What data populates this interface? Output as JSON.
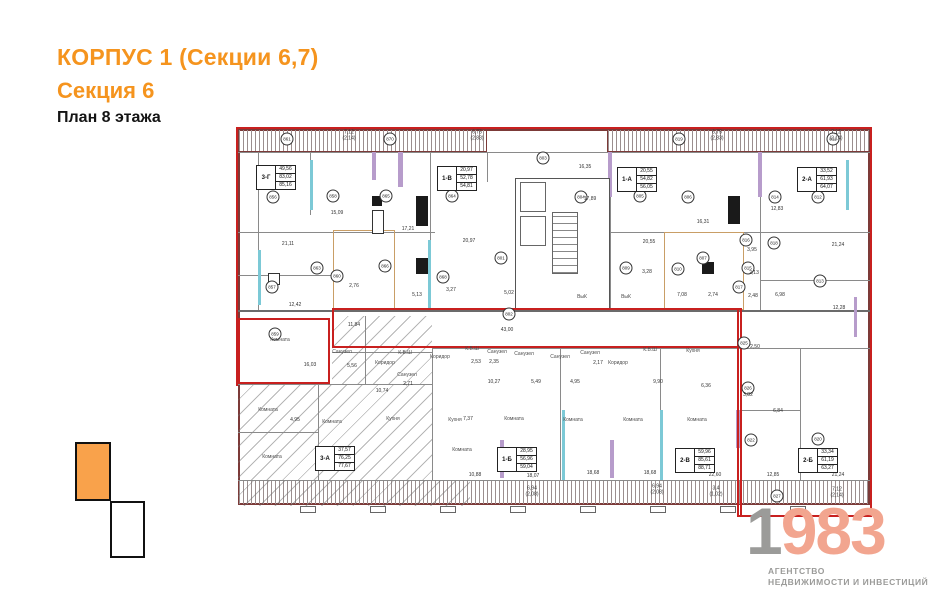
{
  "header": {
    "title": "КОРПУС 1 (Секции 6,7)",
    "subtitle": "Секция 6",
    "floor": "План 8 этажа"
  },
  "colors": {
    "accent_orange": "#F5941E",
    "wall_maroon": "#7C3A38",
    "highlight_red": "#C8201F",
    "teal_wall": "#7CC9D6",
    "purple_wall": "#B79CCB",
    "tan_wall": "#C99E66",
    "logo_gray": "#9B9B99",
    "logo_salmon": "#F2A58F"
  },
  "logo": {
    "year_first": "1",
    "year_rest": "983",
    "tagline1": "АГЕНТСТВО",
    "tagline2": "НЕДВИЖИМОСТИ И ИНВЕСТИЦИЙ"
  },
  "plan": {
    "apartments": [
      {
        "unit": "3-Г",
        "areas": [
          "49,56",
          "83,02",
          "85,16"
        ],
        "x": 23,
        "y": 40
      },
      {
        "unit": "1-В",
        "areas": [
          "20,97",
          "52,78",
          "54,81"
        ],
        "x": 204,
        "y": 41
      },
      {
        "unit": "1-А",
        "areas": [
          "20,55",
          "54,82",
          "56,05"
        ],
        "x": 384,
        "y": 42
      },
      {
        "unit": "2-А",
        "areas": [
          "33,52",
          "61,93",
          "64,07"
        ],
        "x": 564,
        "y": 42
      },
      {
        "unit": "3-А",
        "areas": [
          "37,57",
          "76,25",
          "77,67"
        ],
        "x": 82,
        "y": 321
      },
      {
        "unit": "1-Б",
        "areas": [
          "28,95",
          "56,96",
          "59,04"
        ],
        "x": 264,
        "y": 322
      },
      {
        "unit": "2-В",
        "areas": [
          "59,96",
          "85,61",
          "88,71"
        ],
        "x": 442,
        "y": 323
      },
      {
        "unit": "2-Б",
        "areas": [
          "33,34",
          "61,19",
          "63,27"
        ],
        "x": 565,
        "y": 323
      }
    ],
    "circles": [
      {
        "n": "861",
        "x": 54,
        "y": 14
      },
      {
        "n": "870",
        "x": 157,
        "y": 14
      },
      {
        "n": "819",
        "x": 446,
        "y": 14
      },
      {
        "n": "811",
        "x": 600,
        "y": 14
      },
      {
        "n": "856",
        "x": 40,
        "y": 72
      },
      {
        "n": "858",
        "x": 100,
        "y": 71
      },
      {
        "n": "865",
        "x": 153,
        "y": 71
      },
      {
        "n": "864",
        "x": 219,
        "y": 71
      },
      {
        "n": "803",
        "x": 310,
        "y": 33
      },
      {
        "n": "804",
        "x": 348,
        "y": 72
      },
      {
        "n": "805",
        "x": 407,
        "y": 71
      },
      {
        "n": "806",
        "x": 455,
        "y": 72
      },
      {
        "n": "814",
        "x": 542,
        "y": 72
      },
      {
        "n": "812",
        "x": 585,
        "y": 72
      },
      {
        "n": "857",
        "x": 39,
        "y": 162
      },
      {
        "n": "863",
        "x": 84,
        "y": 143
      },
      {
        "n": "860",
        "x": 104,
        "y": 151
      },
      {
        "n": "866",
        "x": 152,
        "y": 141
      },
      {
        "n": "868",
        "x": 210,
        "y": 152
      },
      {
        "n": "801",
        "x": 268,
        "y": 133
      },
      {
        "n": "809",
        "x": 393,
        "y": 143
      },
      {
        "n": "807",
        "x": 470,
        "y": 133
      },
      {
        "n": "810",
        "x": 445,
        "y": 144
      },
      {
        "n": "816",
        "x": 513,
        "y": 115
      },
      {
        "n": "818",
        "x": 541,
        "y": 118
      },
      {
        "n": "815",
        "x": 515,
        "y": 143
      },
      {
        "n": "817",
        "x": 506,
        "y": 162
      },
      {
        "n": "813",
        "x": 587,
        "y": 156
      },
      {
        "n": "802",
        "x": 276,
        "y": 189
      },
      {
        "n": "859",
        "x": 42,
        "y": 209
      },
      {
        "n": "825",
        "x": 511,
        "y": 218
      },
      {
        "n": "826",
        "x": 515,
        "y": 263
      },
      {
        "n": "822",
        "x": 518,
        "y": 315
      },
      {
        "n": "820",
        "x": 585,
        "y": 314
      },
      {
        "n": "827",
        "x": 544,
        "y": 371
      }
    ],
    "dims": [
      {
        "t": "21,11",
        "x": 55,
        "y": 120
      },
      {
        "t": "15,09",
        "x": 104,
        "y": 89
      },
      {
        "t": "17,21",
        "x": 175,
        "y": 105
      },
      {
        "t": "20,97",
        "x": 236,
        "y": 117
      },
      {
        "t": "12,42",
        "x": 62,
        "y": 181
      },
      {
        "t": "2,76",
        "x": 121,
        "y": 162
      },
      {
        "t": "5,13",
        "x": 184,
        "y": 171
      },
      {
        "t": "11,84",
        "x": 121,
        "y": 201
      },
      {
        "t": "16,03",
        "x": 77,
        "y": 241
      },
      {
        "t": "5,56",
        "x": 119,
        "y": 242
      },
      {
        "t": "4,95",
        "x": 62,
        "y": 296
      },
      {
        "t": "10,74",
        "x": 149,
        "y": 267
      },
      {
        "t": "16,35",
        "x": 352,
        "y": 43
      },
      {
        "t": "17,89",
        "x": 357,
        "y": 75
      },
      {
        "t": "20,55",
        "x": 416,
        "y": 118
      },
      {
        "t": "16,31",
        "x": 470,
        "y": 98
      },
      {
        "t": "12,83",
        "x": 544,
        "y": 85
      },
      {
        "t": "3,95",
        "x": 519,
        "y": 126
      },
      {
        "t": "2,13",
        "x": 521,
        "y": 149
      },
      {
        "t": "21,24",
        "x": 605,
        "y": 121
      },
      {
        "t": "3,28",
        "x": 414,
        "y": 148
      },
      {
        "t": "7,08",
        "x": 449,
        "y": 171
      },
      {
        "t": "2,74",
        "x": 480,
        "y": 171
      },
      {
        "t": "2,48",
        "x": 520,
        "y": 172
      },
      {
        "t": "6,98",
        "x": 547,
        "y": 171
      },
      {
        "t": "12,28",
        "x": 606,
        "y": 184
      },
      {
        "t": "3,27",
        "x": 218,
        "y": 166
      },
      {
        "t": "5,02",
        "x": 276,
        "y": 169
      },
      {
        "t": "43,00",
        "x": 274,
        "y": 206
      },
      {
        "t": "2,50",
        "x": 522,
        "y": 223
      },
      {
        "t": "3,82",
        "x": 515,
        "y": 271
      },
      {
        "t": "2,53",
        "x": 243,
        "y": 238
      },
      {
        "t": "2,35",
        "x": 261,
        "y": 238
      },
      {
        "t": "2,17",
        "x": 365,
        "y": 239
      },
      {
        "t": "2,71",
        "x": 175,
        "y": 260
      },
      {
        "t": "10,27",
        "x": 261,
        "y": 258
      },
      {
        "t": "5,49",
        "x": 303,
        "y": 258
      },
      {
        "t": "4,95",
        "x": 342,
        "y": 258
      },
      {
        "t": "9,90",
        "x": 425,
        "y": 258
      },
      {
        "t": "7,37",
        "x": 235,
        "y": 295
      },
      {
        "t": "6,36",
        "x": 473,
        "y": 262
      },
      {
        "t": "6,84",
        "x": 545,
        "y": 287
      },
      {
        "t": "10,88",
        "x": 242,
        "y": 351
      },
      {
        "t": "18,07",
        "x": 300,
        "y": 352
      },
      {
        "t": "18,68",
        "x": 360,
        "y": 349
      },
      {
        "t": "18,68",
        "x": 417,
        "y": 349
      },
      {
        "t": "22,60",
        "x": 482,
        "y": 351
      },
      {
        "t": "12,85",
        "x": 540,
        "y": 351
      },
      {
        "t": "21,24",
        "x": 605,
        "y": 351
      }
    ],
    "dims2": [
      {
        "t": "7,12",
        "s": "(2,14)",
        "x": 116,
        "y": 11
      },
      {
        "t": "6,75",
        "s": "(2,83)",
        "x": 244,
        "y": 11
      },
      {
        "t": "6,75",
        "s": "(2,83)",
        "x": 484,
        "y": 11
      },
      {
        "t": "7,12",
        "s": "(2,14)",
        "x": 603,
        "y": 11
      },
      {
        "t": "6,94",
        "s": "(2,08)",
        "x": 299,
        "y": 367
      },
      {
        "t": "6,94",
        "s": "(2,08)",
        "x": 424,
        "y": 365
      },
      {
        "t": "3,4",
        "s": "(1,02)",
        "x": 483,
        "y": 367
      },
      {
        "t": "7,12",
        "s": "(2,14)",
        "x": 604,
        "y": 368
      }
    ],
    "rooms": [
      {
        "t": "Комната",
        "x": 35,
        "y": 285
      },
      {
        "t": "Комната",
        "x": 99,
        "y": 297
      },
      {
        "t": "Комната",
        "x": 39,
        "y": 332
      },
      {
        "t": "Комната",
        "x": 229,
        "y": 325
      },
      {
        "t": "Комната",
        "x": 281,
        "y": 294
      },
      {
        "t": "Комната",
        "x": 340,
        "y": 295
      },
      {
        "t": "Комната",
        "x": 400,
        "y": 295
      },
      {
        "t": "Комната",
        "x": 464,
        "y": 295
      },
      {
        "t": "Комната",
        "x": 47,
        "y": 215
      },
      {
        "t": "Кухня",
        "x": 160,
        "y": 294
      },
      {
        "t": "Кухня",
        "x": 222,
        "y": 295
      },
      {
        "t": "Кухня",
        "x": 460,
        "y": 226
      },
      {
        "t": "Коридор",
        "x": 207,
        "y": 232
      },
      {
        "t": "Коридор",
        "x": 152,
        "y": 238
      },
      {
        "t": "Коридор",
        "x": 385,
        "y": 238
      },
      {
        "t": "Санузел",
        "x": 109,
        "y": 227
      },
      {
        "t": "Санузел",
        "x": 264,
        "y": 227
      },
      {
        "t": "Санузел",
        "x": 291,
        "y": 229
      },
      {
        "t": "Санузел",
        "x": 327,
        "y": 232
      },
      {
        "t": "Санузел",
        "x": 357,
        "y": 228
      },
      {
        "t": "Санузел",
        "x": 174,
        "y": 250
      },
      {
        "t": "К.В.Ш",
        "x": 239,
        "y": 224
      },
      {
        "t": "К.В.Ш",
        "x": 417,
        "y": 225
      },
      {
        "t": "К.В.Ш",
        "x": 172,
        "y": 228
      },
      {
        "t": "ВыК",
        "x": 349,
        "y": 172
      },
      {
        "t": "ВыК",
        "x": 393,
        "y": 172
      }
    ]
  }
}
